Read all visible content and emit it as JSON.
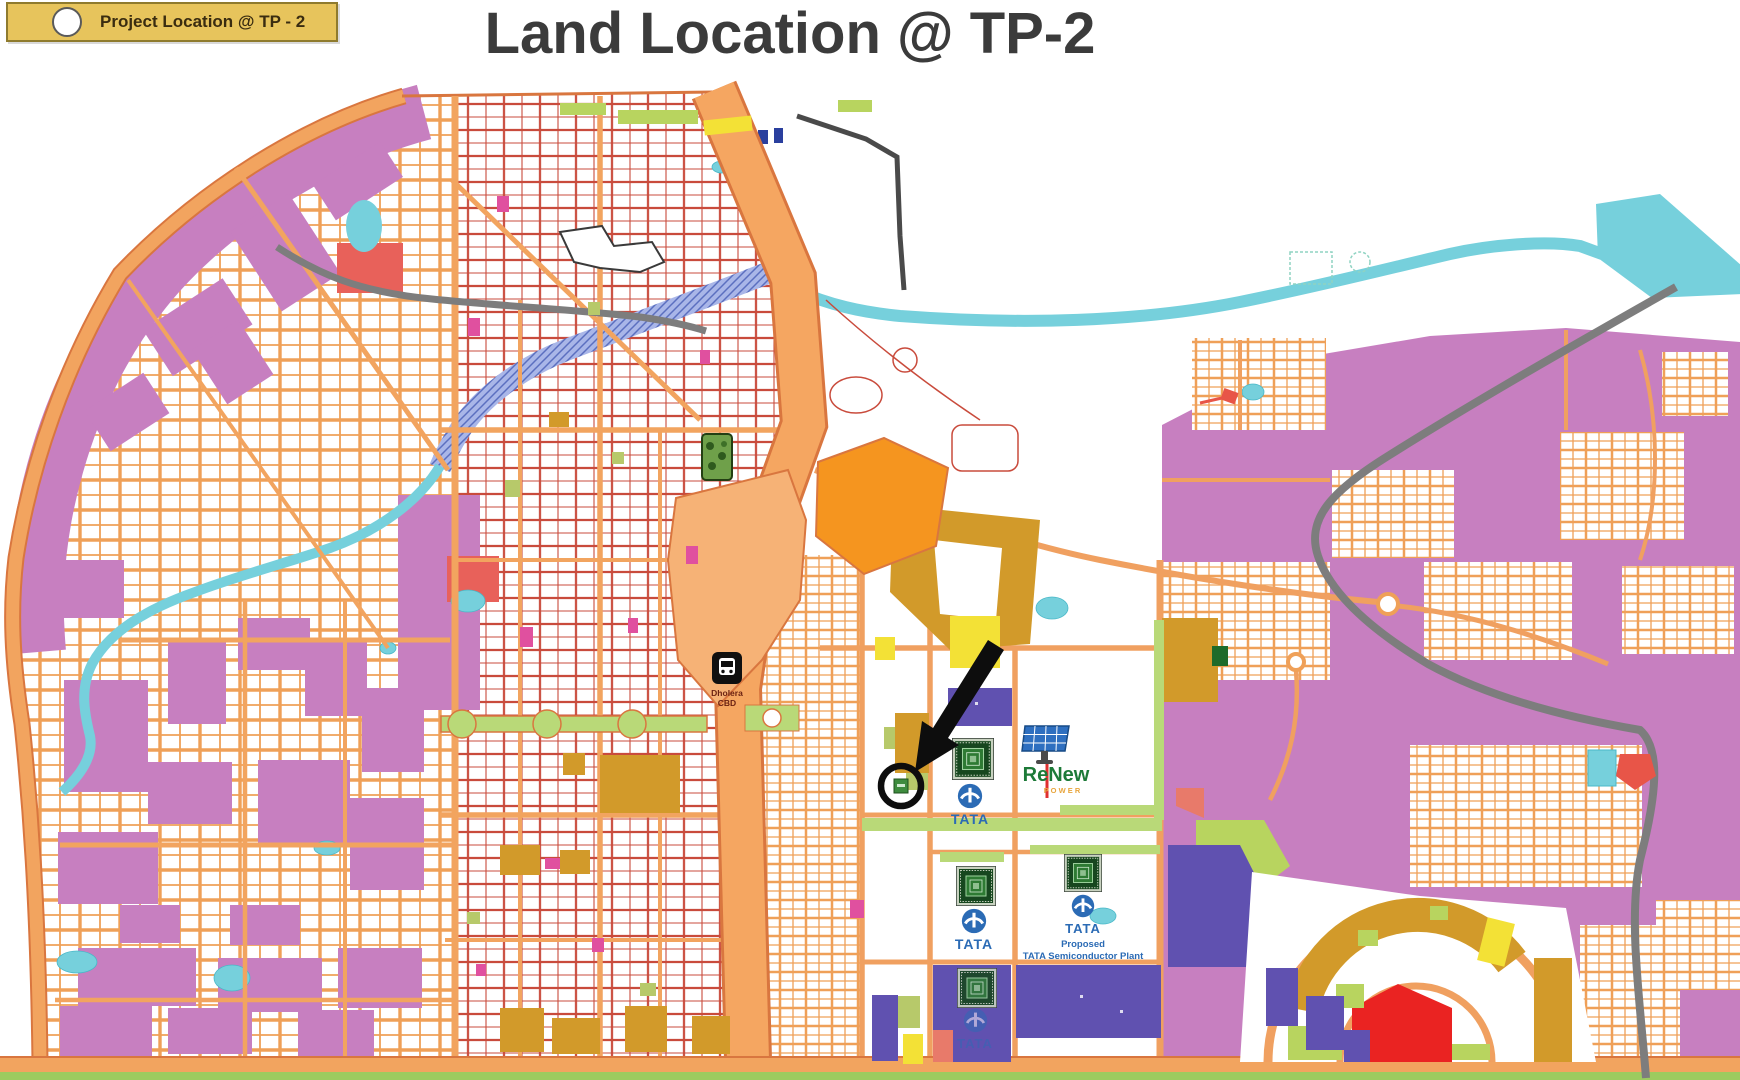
{
  "slide": {
    "title": "Land Location @ TP-2"
  },
  "legend": {
    "label": "Project Location @ TP - 2",
    "marker": "white-circle-in-gold-box"
  },
  "map": {
    "station": {
      "name_line1": "Dholera",
      "name_line2": "CBD",
      "icon": "train-icon"
    },
    "tata": {
      "wordmark": "TATA",
      "proposed_line1": "Proposed",
      "proposed_line2": "TATA Semiconductor Plant",
      "brand_color": "#2B6BB5"
    },
    "renew": {
      "wordmark": "ReNew",
      "subtitle": "P O W E R",
      "green": "#1D7A38",
      "amber": "#E8A53C"
    },
    "marker": {
      "type": "project-location-circle",
      "color": "#0D0D0D"
    },
    "icons": [
      "train-icon",
      "semiconductor-chip-icon",
      "solar-panel-icon",
      "city-park-icon",
      "black-arrow-icon",
      "project-circle-marker"
    ],
    "colors": {
      "highway_orange": "#F5A661",
      "road_casing": "#D9763F",
      "road_line_red": "#C94B3C",
      "parcel_purple": "#C77FC0",
      "parcel_magenta": "#E0509F",
      "parcel_indigo": "#6051B0",
      "parcel_ochre": "#D29A2A",
      "parcel_yellow": "#F3E136",
      "parcel_green": "#B9D978",
      "parcel_red": "#EA2322",
      "parcel_salmon": "#E87A6A",
      "water_cyan": "#76D0DC",
      "river_blue_hatch": "#96A7E3",
      "rail_gray": "#7D7D7D",
      "solid_orange_zone": "#F5951F",
      "legend_gold": "#E7C45C"
    }
  }
}
